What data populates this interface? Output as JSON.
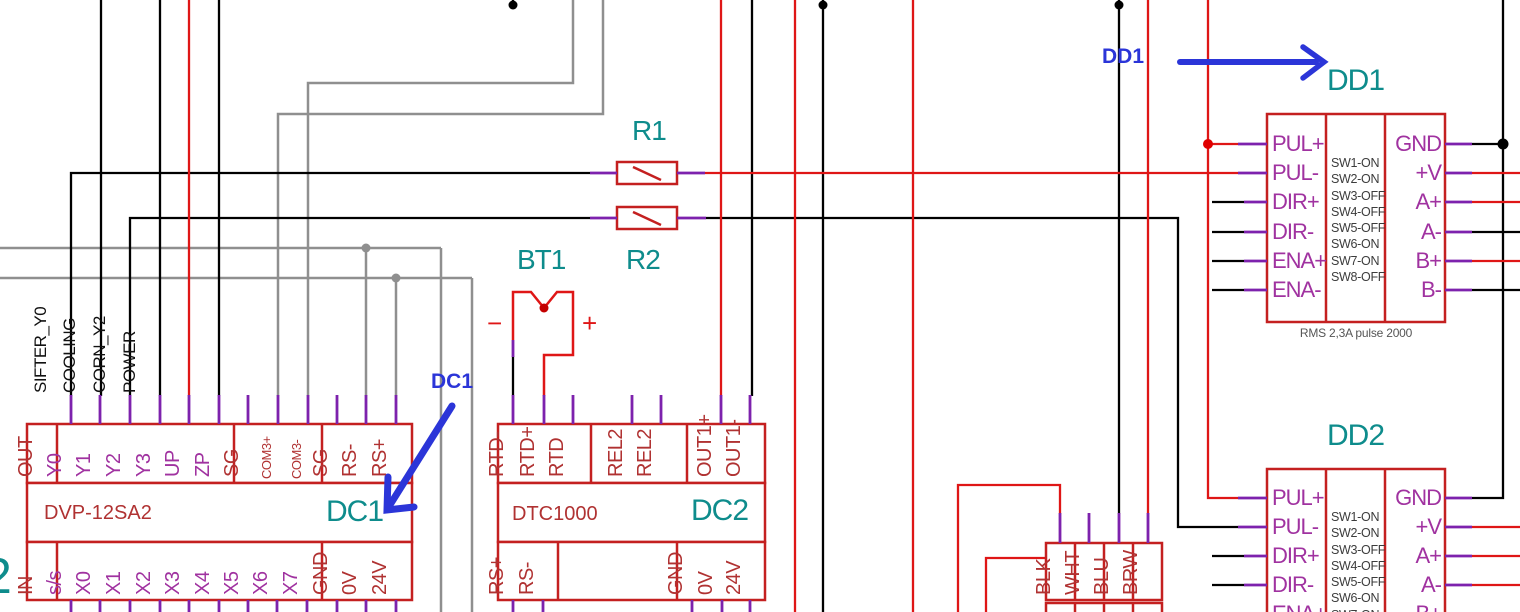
{
  "diagram_type": "electrical-schematic",
  "colors": {
    "wire_black": "#000000",
    "wire_red": "#df1616",
    "wire_gray": "#8f8f8f",
    "stub_purple": "#7d22ad",
    "box_red": "#c42020",
    "text_red": "#b03232",
    "text_magenta": "#a032a0",
    "ref_teal": "#0e8c8c",
    "annotation_blue": "#2b35d8"
  },
  "wire_labels": [
    "SIFTER_Y0",
    "COOLING",
    "CORN_Y2",
    "POWER"
  ],
  "annotations": {
    "dd1": "DD1",
    "dc1": "DC1"
  },
  "edge_label": "2",
  "dc1": {
    "ref": "DC1",
    "part": "DVP-12SA2",
    "top_pins": [
      "OUT",
      "Y0",
      "Y1",
      "Y2",
      "Y3",
      "UP",
      "ZP",
      "SG",
      "COM3+",
      "COM3-",
      "SG",
      "RS-",
      "RS+"
    ],
    "bottom_pins": [
      "IN",
      "s/s",
      "X0",
      "X1",
      "X2",
      "X3",
      "X4",
      "X5",
      "X6",
      "X7",
      "GND",
      "0V",
      "24V"
    ]
  },
  "dc2": {
    "ref": "DC2",
    "part": "DTC1000",
    "top_pins": [
      "RTD-",
      "RTD+",
      "RTD",
      "REL2",
      "REL2",
      "OUT1+",
      "OUT1-"
    ],
    "bottom_pins": [
      "RS+",
      "RS-",
      "GND",
      "0V",
      "24V"
    ]
  },
  "r1": {
    "ref": "R1"
  },
  "r2": {
    "ref": "R2"
  },
  "bt1": {
    "ref": "BT1",
    "minus": "−",
    "plus": "+"
  },
  "sw_settings": [
    "SW1-ON",
    "SW2-ON",
    "SW3-OFF",
    "SW4-OFF",
    "SW5-OFF",
    "SW6-ON",
    "SW7-ON",
    "SW8-OFF"
  ],
  "dd1": {
    "ref": "DD1",
    "left_pins": [
      "PUL+",
      "PUL-",
      "DIR+",
      "DIR-",
      "ENA+",
      "ENA-"
    ],
    "right_pins": [
      "GND",
      "+V",
      "A+",
      "A-",
      "B+",
      "B-"
    ],
    "note": "RMS 2,3A pulse 2000"
  },
  "dd2": {
    "ref": "DD2",
    "left_pins": [
      "PUL+",
      "PUL-",
      "DIR+",
      "DIR-",
      "ENA+"
    ],
    "right_pins": [
      "GND",
      "+V",
      "A+",
      "A-",
      "B+"
    ]
  },
  "connector": {
    "pins": [
      "BLK",
      "WHT",
      "BLU",
      "BRW"
    ]
  }
}
